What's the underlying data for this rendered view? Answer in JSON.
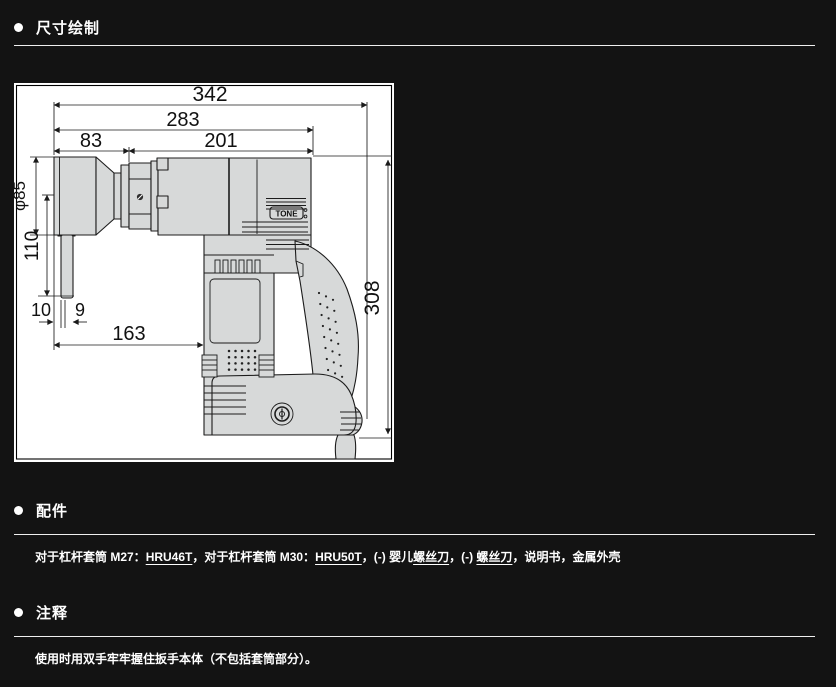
{
  "colors": {
    "page_bg": "#131313",
    "text": "#ffffff",
    "rule": "#efefef",
    "drawing_bg": "#ffffff",
    "drawing_line": "#1c1c1c",
    "tool_fill": "#d7d9d9"
  },
  "sections": {
    "dimensions": {
      "title": "尺寸绘制"
    },
    "accessories": {
      "title": "配件",
      "line": [
        {
          "text": "对于杠杆套筒 M27："
        },
        {
          "text": "HRU46T"
        },
        {
          "text": "，对于杠杆套筒 M30："
        },
        {
          "text": "HRU50T"
        },
        {
          "text": "，(-) 婴儿"
        },
        {
          "text": "螺丝刀"
        },
        {
          "text": "，(-) "
        },
        {
          "text": "螺丝刀"
        },
        {
          "text": "，说明书，金属外壳"
        }
      ]
    },
    "notes": {
      "title": "注释",
      "text": "使用时用双手牢牢握住扳手本体（不包括套筒部分）。"
    }
  },
  "drawing": {
    "logo": "TONE",
    "dims": {
      "total_length": "342",
      "body_length": "283",
      "head_length": "83",
      "motor_length": "201",
      "socket_diameter": "φ85",
      "lever_length": "110",
      "lever_offset": "10",
      "lever_width": "9",
      "head_to_body": "163",
      "total_height": "308"
    }
  }
}
